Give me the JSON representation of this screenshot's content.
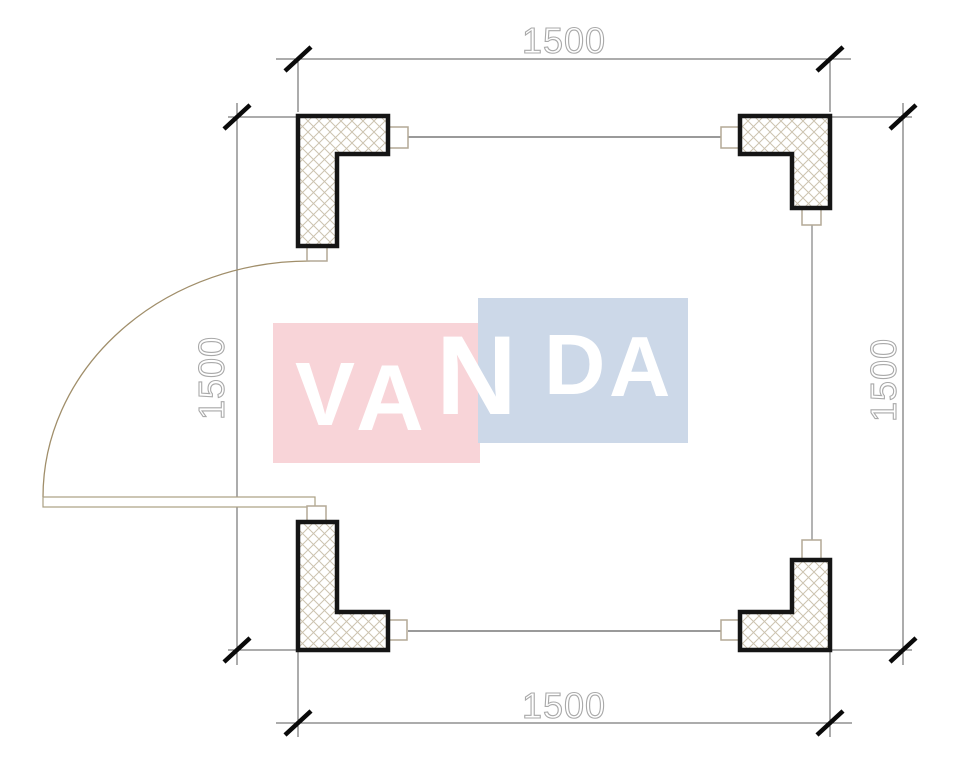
{
  "watermark": {
    "text": "VANDA",
    "letters": [
      "V",
      "A",
      "N",
      "D",
      "A"
    ]
  },
  "dimensions": {
    "top": "1500",
    "bottom": "1500",
    "left": "1500",
    "right": "1500"
  },
  "colors": {
    "wm-pink": "#f8d4d8",
    "wm-blue": "#ccd8e8",
    "wm-text": "#ffffff",
    "column-outline": "#151515",
    "hatch": "#ccc3b0",
    "wall-line": "#9a9a9a",
    "dim-line": "#5a5a5a",
    "dim-text": "#a9a9a9",
    "tick": "#0a0a0a",
    "door-arc": "#a08e6a",
    "door-leaf": "#ab9f83",
    "tab-outline": "#b3a995",
    "canvas-bg": "#ffffff"
  }
}
